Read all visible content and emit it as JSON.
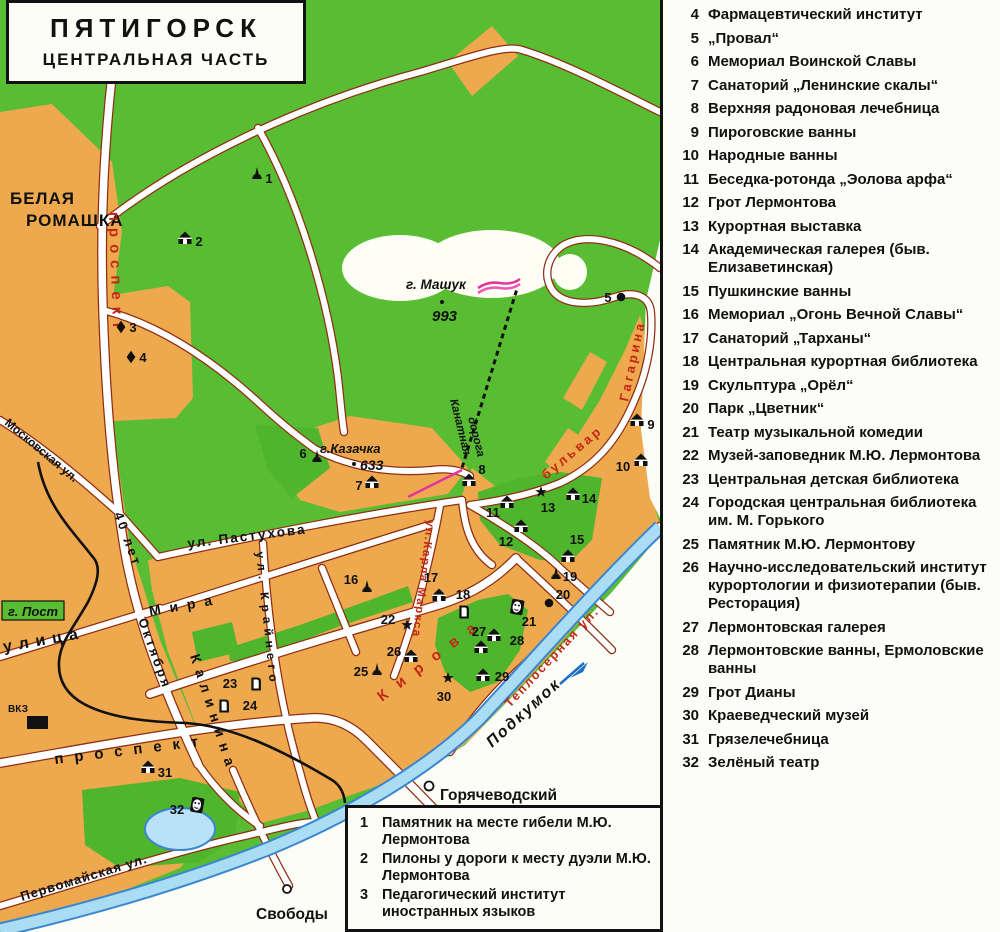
{
  "colors": {
    "park_green": "#58bd33",
    "city_orange": "#eea84e",
    "road_casing": "#8f2e12",
    "river_fill": "#aadcf3",
    "river_edge": "#3a86cf",
    "label_red": "#c22815",
    "district_red": "#8f1d12",
    "magenta": "#e2369e"
  },
  "title": {
    "line1": "ПЯТИГОРСК",
    "line2": "ЦЕНТРАЛЬНАЯ ЧАСТЬ"
  },
  "map": {
    "labels": {
      "district1": "БЕЛАЯ",
      "district2": "РОМАШКА",
      "prospekt40": "проспект",
      "sorok_let": "40 лет",
      "oktyabrya": "Октября",
      "moskovskaya": "Московская ул.",
      "ulitsa": "улица",
      "mira": "Мира",
      "pastukhova": "ул. Пастухова",
      "kraynego": "ул. Крайнего",
      "karla_marksa": "ул.Карла Маркса",
      "kirova": "Кирова",
      "prospekt_bottom": "проспект",
      "kalinina": "Калинина",
      "bulvar": "бульвар",
      "gagarina": "Гагарина",
      "teplosernaya": "Теплосерная ул.",
      "pervomayskaya": "Первомайская ул.",
      "mashuk": "г. Машук",
      "mashuk_elev": "993",
      "kazachka": "г.Казачка",
      "kazachka_elev": "633",
      "kanatnaya1": "Канатная",
      "kanatnaya2": "дорога",
      "podkumok": "Подкумок",
      "svobody": "Свободы",
      "goryachevodsky": "Горячеводский",
      "post": "г. Пост",
      "vkz": "ВКЗ"
    },
    "markers": [
      "1",
      "2",
      "3",
      "4",
      "5",
      "6",
      "7",
      "8",
      "9",
      "10",
      "11",
      "12",
      "13",
      "14",
      "15",
      "16",
      "17",
      "18",
      "19",
      "20",
      "21",
      "22",
      "23",
      "24",
      "25",
      "26",
      "27",
      "28",
      "29",
      "30",
      "31",
      "32"
    ]
  },
  "legend_box": {
    "items": [
      {
        "num": "1",
        "text": "Памятник на месте гибели М.Ю. Лермонтова"
      },
      {
        "num": "2",
        "text": "Пилоны у дороги к месту дуэли М.Ю. Лермонтова"
      },
      {
        "num": "3",
        "text": "Педагогический институт иностранных языков"
      }
    ]
  },
  "legend_panel": {
    "items": [
      {
        "num": "4",
        "text": "Фармацевтический институт"
      },
      {
        "num": "5",
        "text": "„Провал“"
      },
      {
        "num": "6",
        "text": "Мемориал Воинской Славы"
      },
      {
        "num": "7",
        "text": "Санаторий „Ленинские скалы“"
      },
      {
        "num": "8",
        "text": "Верхняя радоновая лечебница"
      },
      {
        "num": "9",
        "text": "Пироговские ванны"
      },
      {
        "num": "10",
        "text": "Народные ванны"
      },
      {
        "num": "11",
        "text": "Беседка-ротонда „Эолова арфа“"
      },
      {
        "num": "12",
        "text": "Грот Лермонтова"
      },
      {
        "num": "13",
        "text": "Курортная выставка"
      },
      {
        "num": "14",
        "text": "Академическая галерея (быв. Елизаветинская)"
      },
      {
        "num": "15",
        "text": "Пушкинские ванны"
      },
      {
        "num": "16",
        "text": "Мемориал „Огонь Вечной Славы“"
      },
      {
        "num": "17",
        "text": "Санаторий „Тарханы“"
      },
      {
        "num": "18",
        "text": "Центральная курортная библиотека"
      },
      {
        "num": "19",
        "text": "Скульптура „Орёл“"
      },
      {
        "num": "20",
        "text": "Парк „Цветник“"
      },
      {
        "num": "21",
        "text": "Театр музыкальной комедии"
      },
      {
        "num": "22",
        "text": "Музей-заповедник М.Ю. Лермонтова"
      },
      {
        "num": "23",
        "text": "Центральная детская библиотека"
      },
      {
        "num": "24",
        "text": "Городская центральная библиотека им. М. Горького"
      },
      {
        "num": "25",
        "text": "Памятник М.Ю. Лермонтову"
      },
      {
        "num": "26",
        "text": "Научно-исследовательский институт курортологии и физиотерапии (быв. Ресторация)"
      },
      {
        "num": "27",
        "text": "Лермонтовская галерея"
      },
      {
        "num": "28",
        "text": "Лермонтовские ванны, Ермоловские ванны"
      },
      {
        "num": "29",
        "text": "Грот Дианы"
      },
      {
        "num": "30",
        "text": "Краеведческий музей"
      },
      {
        "num": "31",
        "text": "Грязелечебница"
      },
      {
        "num": "32",
        "text": "Зелёный театр"
      }
    ]
  }
}
